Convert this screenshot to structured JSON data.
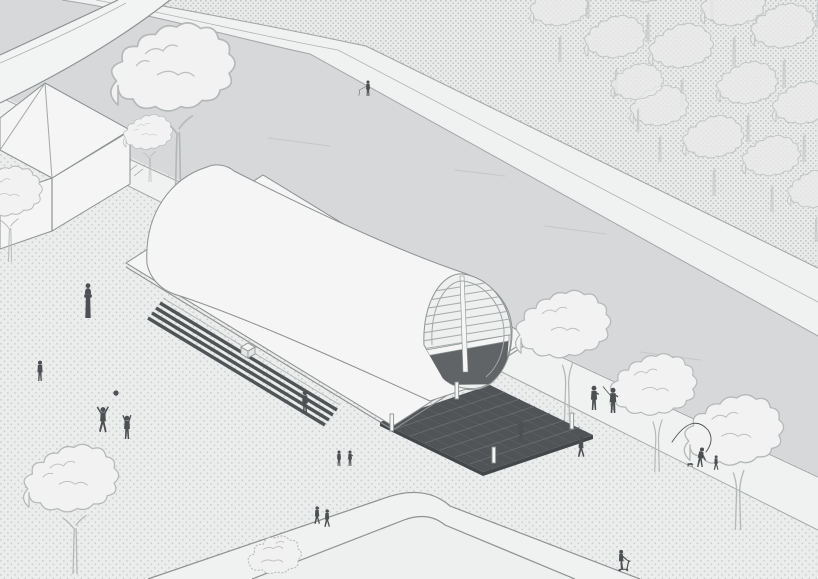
{
  "scene": {
    "type": "axonometric-site-illustration",
    "description": "Isometric architectural illustration: barrel-vaulted pavilion with flat canopy on a dark plinth, set on a dotted riverside plaza with bridge, kiosk, forest bank, trees and pedestrians",
    "width": 818,
    "height": 579
  },
  "colors": {
    "plaza_bg": "#ebecec",
    "plaza_dot": "#c9cbcb",
    "forest_bg": "#e9eaea",
    "forest_dot": "#c2c5c5",
    "river": "#d7d8d9",
    "path": "#f0f1f1",
    "bridge": "#f2f3f3",
    "lawn": "#eef0ef",
    "line": "#a3a7a7",
    "line_dark": "#8d9191",
    "structure_fill": "#f4f5f4",
    "dark": "#515456",
    "dark_hatch": "#6e7273",
    "people": "#4d5052",
    "tree_line": "#b5b8b8",
    "tree_fill": "#f1f2f1",
    "tree_shade": "#dcdede",
    "streak": "#c5c7c8"
  },
  "statue": {
    "id": "plaza-statue",
    "x": 88,
    "y": 318
  },
  "people": [
    {
      "id": "fisher-far-bank",
      "pose": "fishing",
      "x": 368,
      "y": 96,
      "h": 16
    },
    {
      "id": "person-by-steps",
      "pose": "standing",
      "x": 305,
      "y": 413,
      "h": 23
    },
    {
      "id": "pair-center-a",
      "pose": "standing",
      "x": 339,
      "y": 466,
      "h": 16
    },
    {
      "id": "pair-center-b",
      "pose": "standing2",
      "x": 350,
      "y": 466,
      "h": 16
    },
    {
      "id": "person-waving",
      "pose": "waving",
      "x": 521,
      "y": 442,
      "h": 21
    },
    {
      "id": "ball-player-left",
      "pose": "jumping",
      "x": 103,
      "y": 433,
      "h": 26
    },
    {
      "id": "ball-player-right",
      "pose": "reaching",
      "x": 127,
      "y": 439,
      "h": 24
    },
    {
      "id": "person-left-plaza",
      "pose": "standing",
      "x": 40,
      "y": 381,
      "h": 21
    },
    {
      "id": "promenade-a",
      "pose": "standing2",
      "x": 594,
      "y": 410,
      "h": 25
    },
    {
      "id": "promenade-b",
      "pose": "rodshoulder",
      "x": 613,
      "y": 413,
      "h": 26
    },
    {
      "id": "verge-walker",
      "pose": "walking",
      "x": 581,
      "y": 457,
      "h": 21
    },
    {
      "id": "dog-owner",
      "pose": "bending",
      "x": 700,
      "y": 467,
      "h": 22
    },
    {
      "id": "dog",
      "pose": "dog",
      "x": 690,
      "y": 467,
      "h": 10
    },
    {
      "id": "kid",
      "pose": "walking",
      "x": 716,
      "y": 470,
      "h": 15
    },
    {
      "id": "scooter-rider",
      "pose": "scooter",
      "x": 622,
      "y": 570,
      "h": 21
    },
    {
      "id": "couple-a",
      "pose": "walking",
      "x": 317,
      "y": 524,
      "h": 18
    },
    {
      "id": "couple-b",
      "pose": "walking",
      "x": 327,
      "y": 527,
      "h": 18
    }
  ],
  "trees": [
    {
      "id": "big-behind-pavilion",
      "type": "detail",
      "x": 178,
      "y": 192,
      "s": 1.5
    },
    {
      "id": "left-edge",
      "type": "detail",
      "x": 10,
      "y": 262,
      "s": 0.85
    },
    {
      "id": "kiosk-side",
      "type": "detail",
      "x": 150,
      "y": 182,
      "s": 0.6
    },
    {
      "id": "plaza-bottom-left",
      "type": "detail",
      "x": 75,
      "y": 574,
      "s": 1.15
    },
    {
      "id": "bottom-bush",
      "type": "bush",
      "x": 282,
      "y": 577,
      "s": 1.05
    },
    {
      "id": "bank-1",
      "type": "bank",
      "x": 567,
      "y": 420,
      "s": 1.15
    },
    {
      "id": "bank-2",
      "type": "bank",
      "x": 657,
      "y": 472,
      "s": 1.05
    },
    {
      "id": "bank-3",
      "type": "bank",
      "x": 738,
      "y": 530,
      "s": 1.2
    }
  ],
  "forest_trees": [
    {
      "x": 560,
      "y": 62,
      "s": 0.95
    },
    {
      "x": 588,
      "y": 18,
      "s": 1.0
    },
    {
      "x": 616,
      "y": 96,
      "s": 1.0
    },
    {
      "x": 648,
      "y": 42,
      "s": 1.05
    },
    {
      "x": 682,
      "y": 108,
      "s": 1.05
    },
    {
      "x": 660,
      "y": 162,
      "s": 0.95
    },
    {
      "x": 712,
      "y": 22,
      "s": 1.0
    },
    {
      "x": 714,
      "y": 196,
      "s": 1.0
    },
    {
      "x": 734,
      "y": 66,
      "s": 1.05
    },
    {
      "x": 748,
      "y": 142,
      "s": 1.0
    },
    {
      "x": 772,
      "y": 212,
      "s": 0.95
    },
    {
      "x": 784,
      "y": 88,
      "s": 1.05
    },
    {
      "x": 804,
      "y": 162,
      "s": 1.0
    },
    {
      "x": 816,
      "y": 242,
      "s": 0.9
    },
    {
      "x": 818,
      "y": 28,
      "s": 1.0
    },
    {
      "x": 638,
      "y": 132,
      "s": 0.85
    }
  ],
  "streaks": [
    {
      "x1": 520,
      "y1": 86,
      "x2": 578,
      "y2": 93
    },
    {
      "x1": 700,
      "y1": 116,
      "x2": 762,
      "y2": 124
    },
    {
      "x1": 268,
      "y1": 138,
      "x2": 330,
      "y2": 146
    },
    {
      "x1": 455,
      "y1": 170,
      "x2": 505,
      "y2": 176
    },
    {
      "x1": 545,
      "y1": 226,
      "x2": 606,
      "y2": 234
    },
    {
      "x1": 745,
      "y1": 195,
      "x2": 800,
      "y2": 202
    },
    {
      "x1": 640,
      "y1": 352,
      "x2": 700,
      "y2": 360
    }
  ],
  "props": [
    {
      "id": "volleyball",
      "kind": "circle",
      "cx": 116,
      "cy": 393,
      "r": 2.6
    },
    {
      "id": "casting-line",
      "kind": "path",
      "d": "M 672,442 Q 692,412 708,430 Q 715,440 706,452"
    }
  ]
}
